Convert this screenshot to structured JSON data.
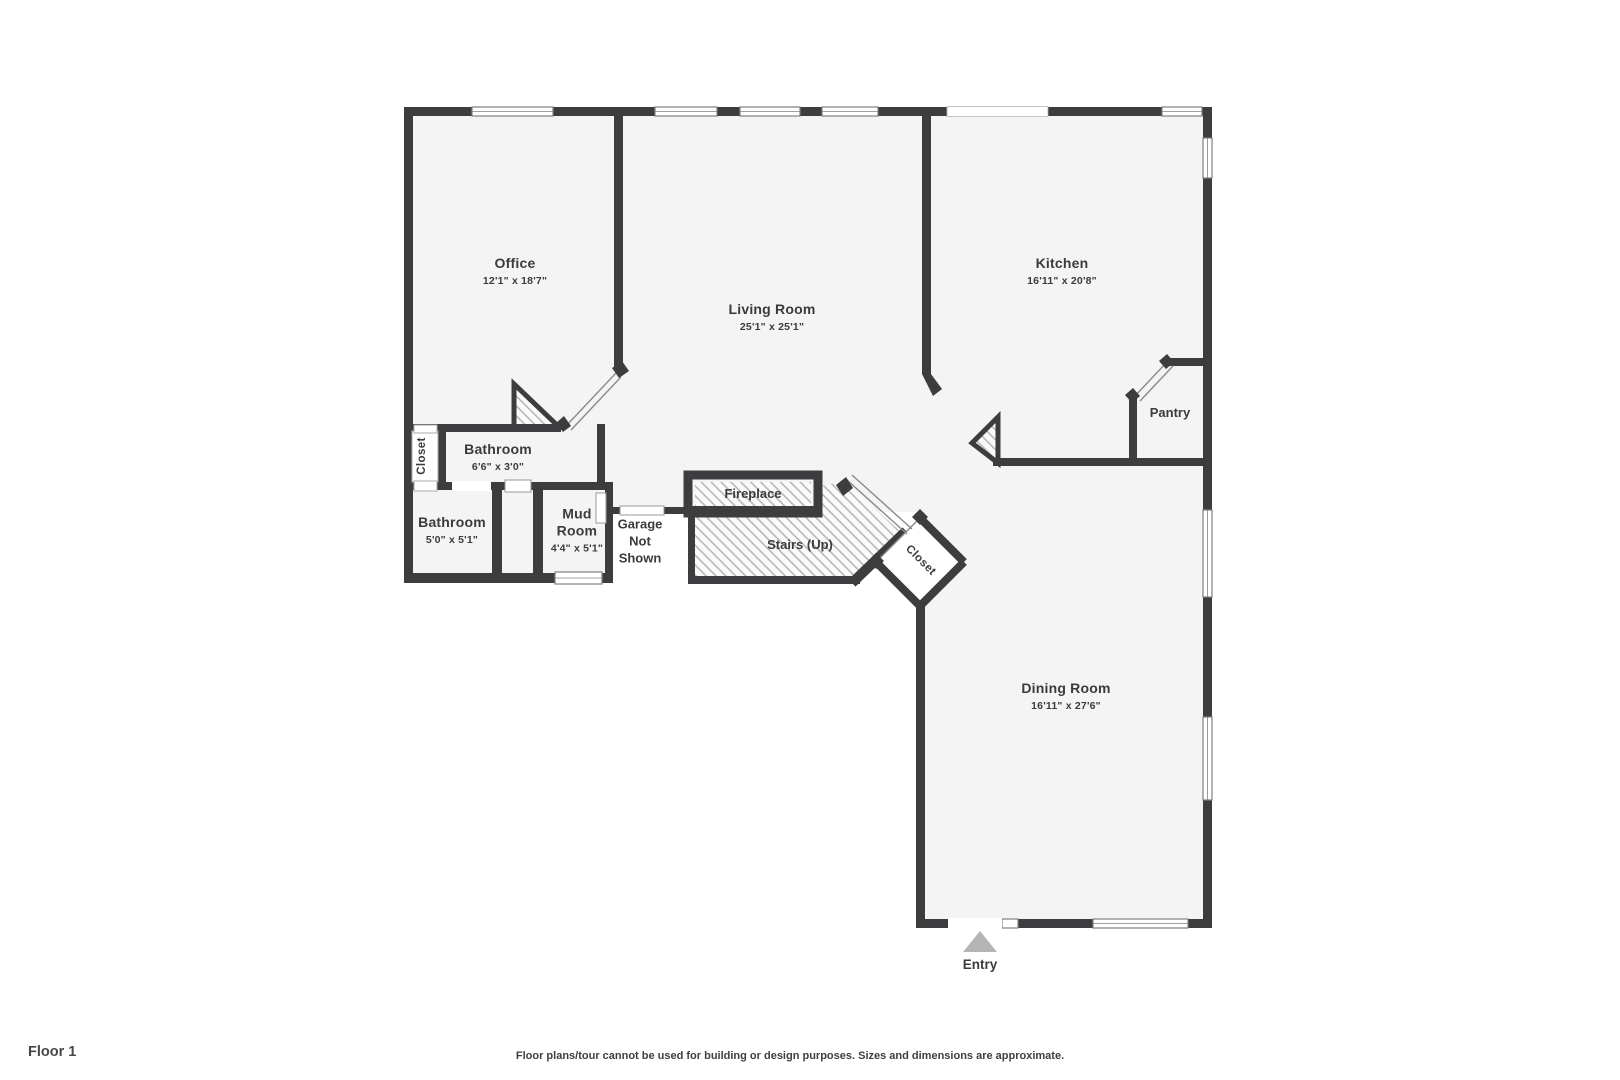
{
  "rooms": [
    {
      "id": "office",
      "name": "Office",
      "dims": "12'1\" x 18'7\""
    },
    {
      "id": "living-room",
      "name": "Living Room",
      "dims": "25'1\" x 25'1\""
    },
    {
      "id": "kitchen",
      "name": "Kitchen",
      "dims": "16'11\" x 20'8\""
    },
    {
      "id": "pantry",
      "name": "Pantry"
    },
    {
      "id": "closet-hall",
      "name": "Closet"
    },
    {
      "id": "bathroom-small",
      "name": "Bathroom",
      "dims": "6'6\" x 3'0\""
    },
    {
      "id": "bathroom",
      "name": "Bathroom",
      "dims": "5'0\" x 5'1\""
    },
    {
      "id": "mud-room",
      "name": "Mud Room",
      "dims": "4'4\" x 5'1\""
    },
    {
      "id": "garage",
      "name": "Garage Not Shown"
    },
    {
      "id": "fireplace",
      "name": "Fireplace"
    },
    {
      "id": "stairs",
      "name": "Stairs (Up)"
    },
    {
      "id": "closet-entry",
      "name": "Closet"
    },
    {
      "id": "dining-room",
      "name": "Dining Room",
      "dims": "16'11\" x 27'6\""
    }
  ],
  "entry": {
    "label": "Entry"
  },
  "footer": {
    "floor_label": "Floor 1",
    "disclaimer": "Floor plans/tour cannot be used for building or design purposes. Sizes and dimensions are approximate."
  },
  "colors": {
    "wall": "#3d3d3f",
    "floor": "#f4f4f5",
    "hatch_line": "#b3b3b3",
    "window_border": "#808080",
    "door_line": "#8a8a8a",
    "entry_arrow": "#b5b5b5",
    "text": "#3b3b3d"
  }
}
